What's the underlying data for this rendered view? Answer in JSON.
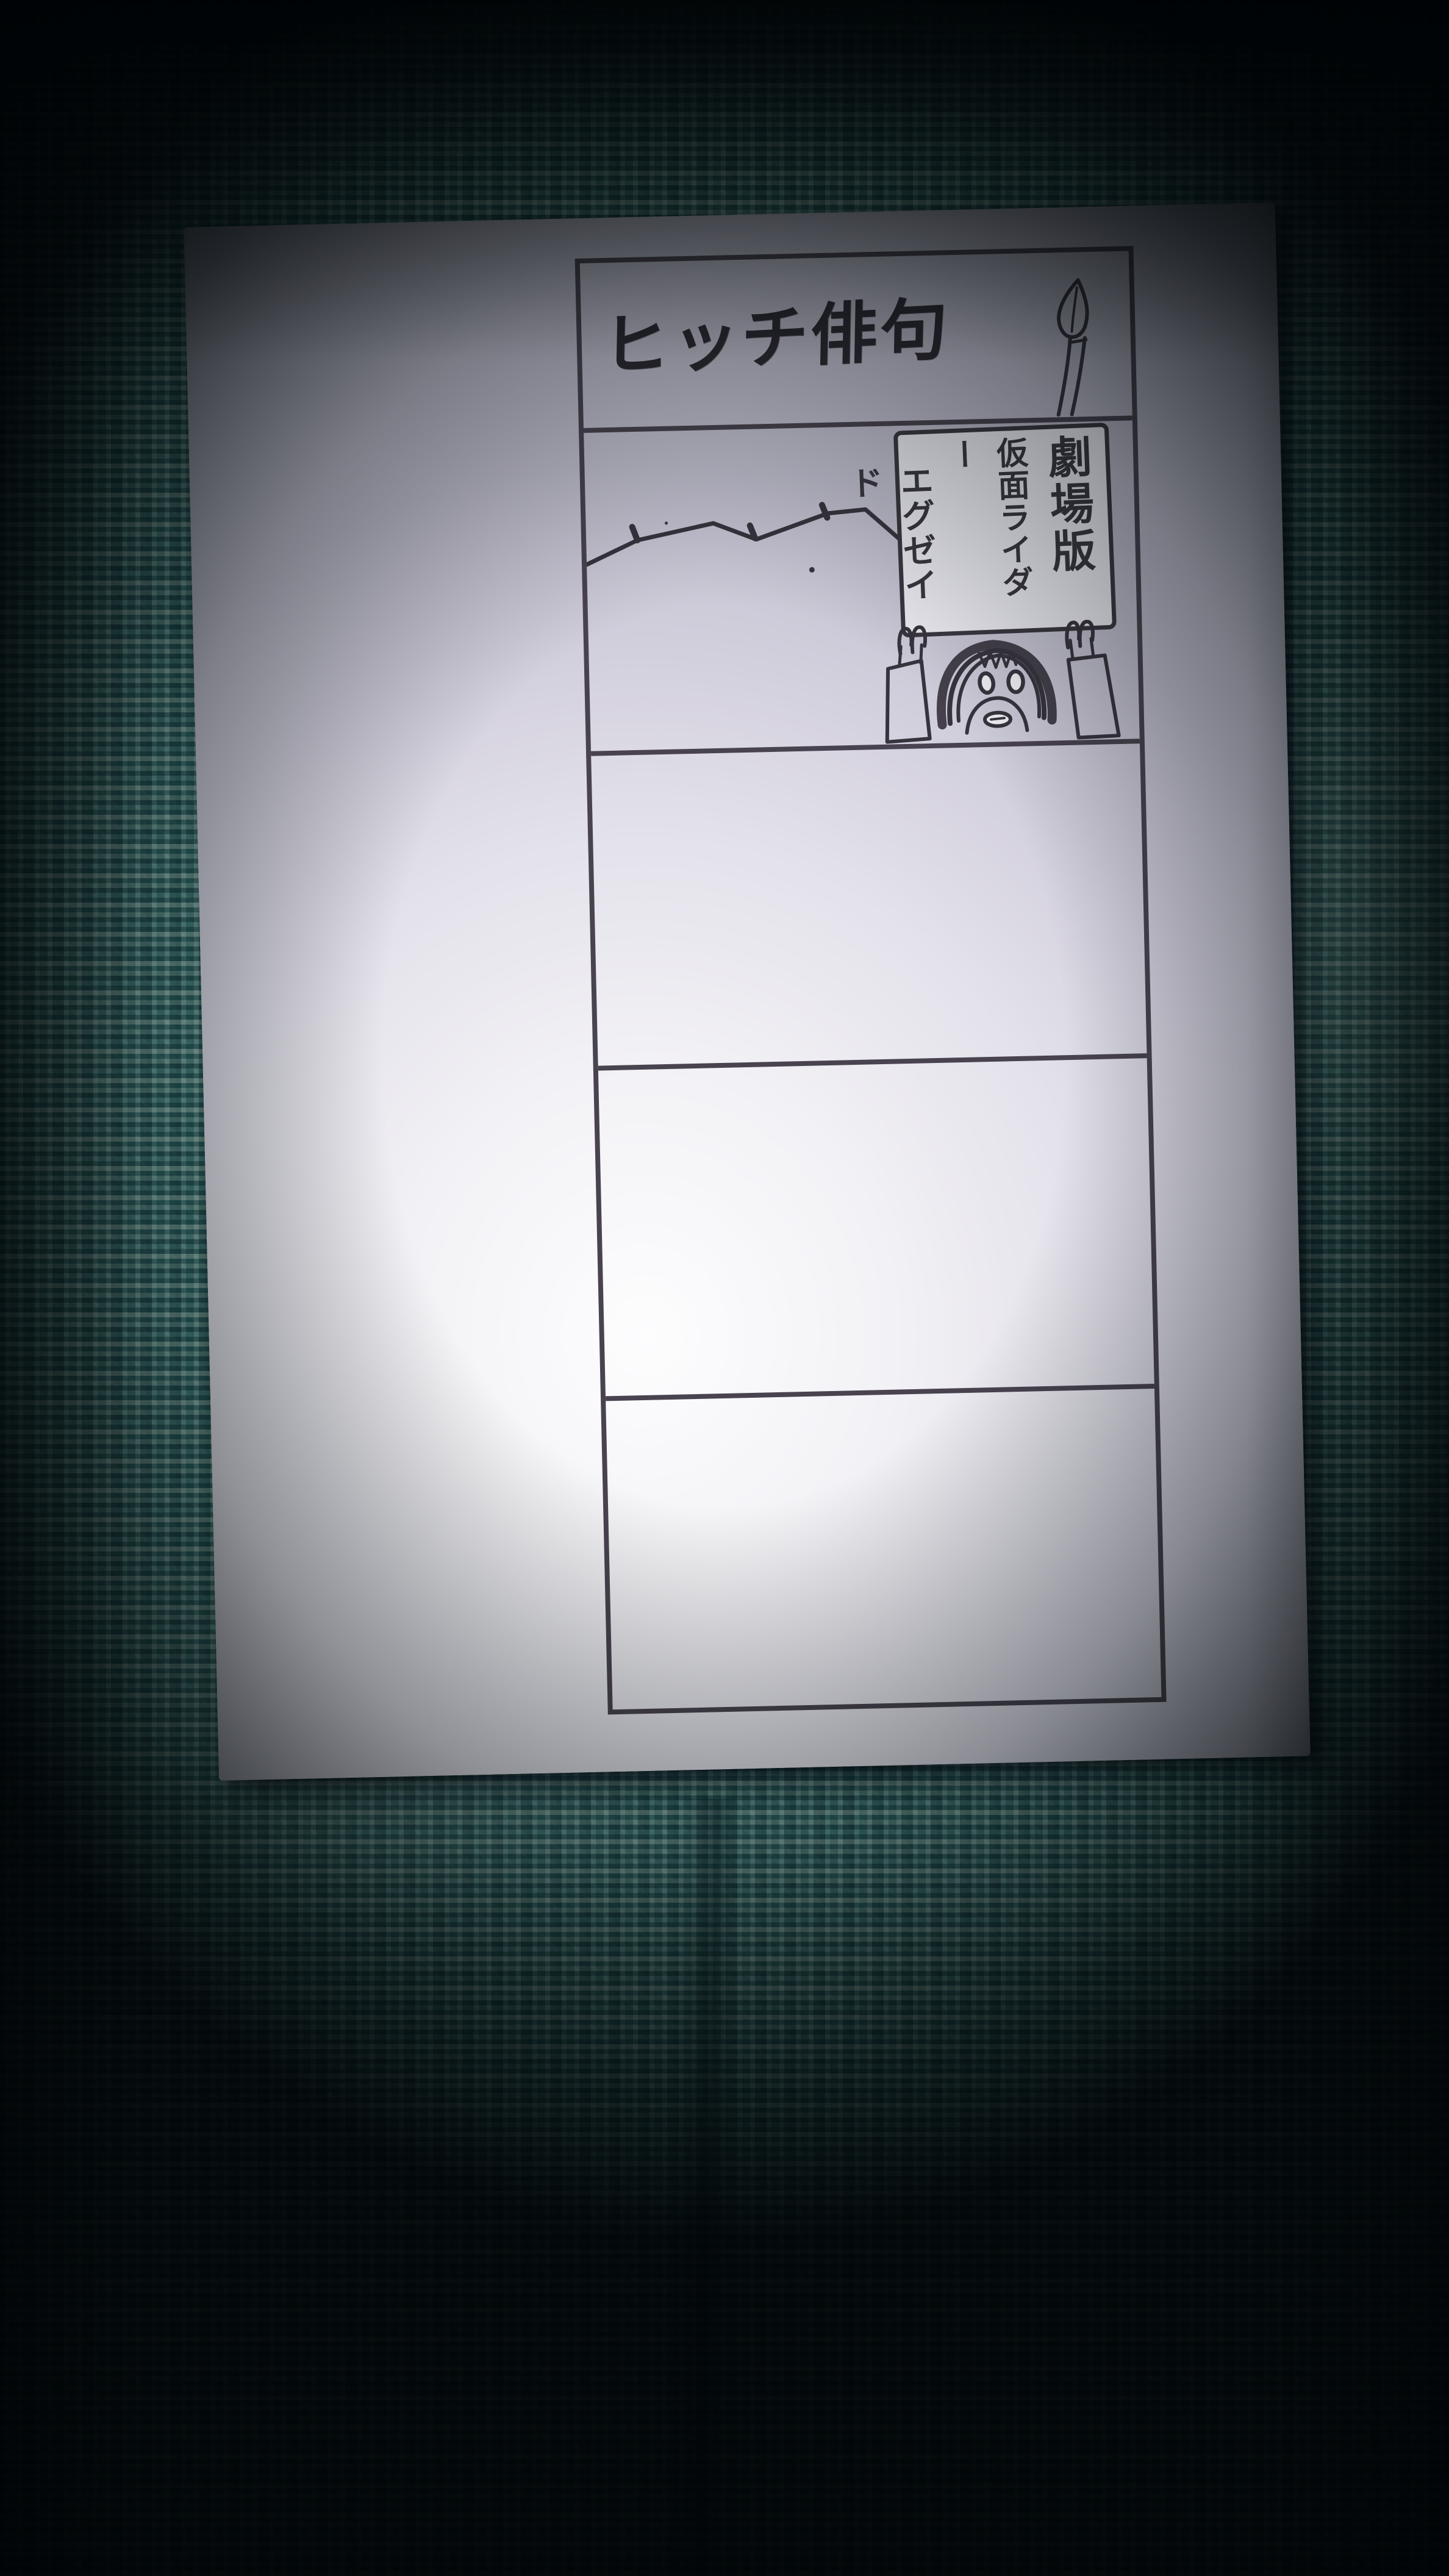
{
  "scene": {
    "type": "photograph",
    "subject": "hand-drawn five-panel vertical comic strip on a white card lying on teal woven fabric",
    "fabric_color": "#53928d",
    "fabric_dark_thread": "#143e42",
    "fabric_light_thread": "#b9cdc0",
    "card_color": "#efeef4",
    "ink_color": "#38343e",
    "frame_line_color": "#49434f"
  },
  "comic": {
    "title": "ヒッチ俳句",
    "panel_count": 5,
    "sign": {
      "columns": [
        "劇場版",
        "仮面ライダー",
        "エグゼイド"
      ]
    }
  }
}
